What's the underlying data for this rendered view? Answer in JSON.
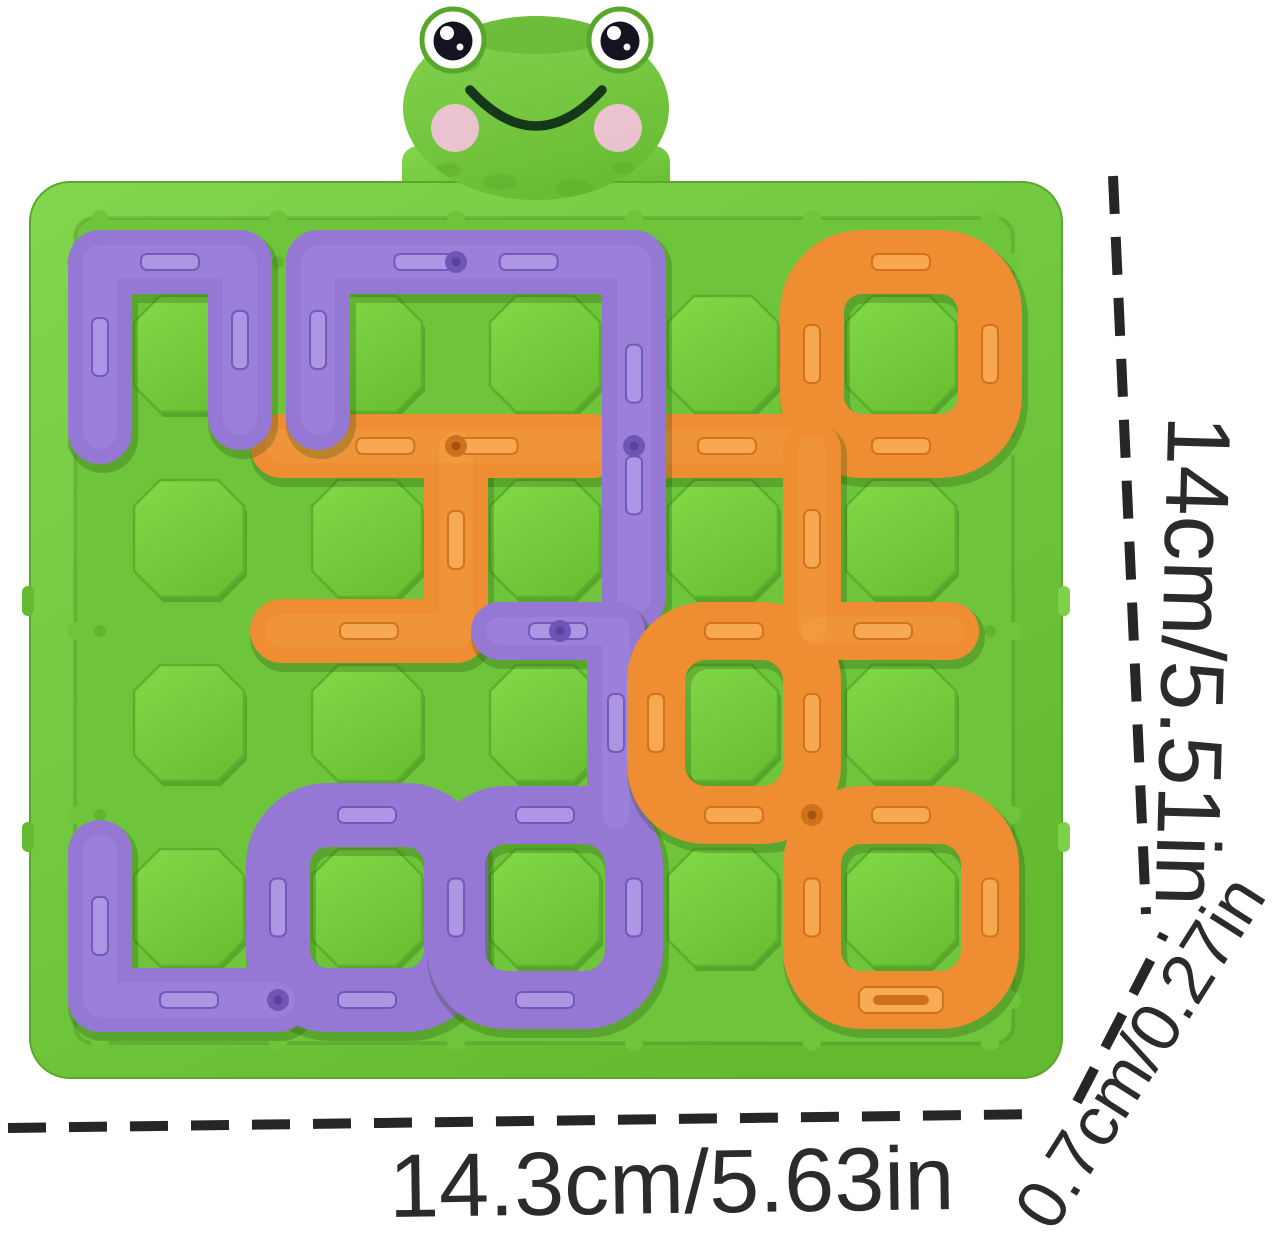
{
  "product": {
    "kind": "frog maze logic puzzle board",
    "annotations": {
      "height_label": "14cm/5.51in",
      "width_label": "14.3cm/5.63in",
      "thickness_label": "0.7cm/0.27in"
    },
    "annotation_style": {
      "color": "#262626",
      "dash": "38 23",
      "line_width": 10
    }
  },
  "board": {
    "colors": {
      "rim1": "#7ed24a",
      "rim2": "#64bb30",
      "field": "#6ec43a",
      "edge": "#5aa72b",
      "cell1": "#80d846",
      "cell2": "#69c133",
      "cellStroke": "#5bb02b",
      "peg": "#5dad2d",
      "shadow": "rgba(40,90,12,0.30)"
    },
    "grid": {
      "cols": 5,
      "rows": 4,
      "xs": [
        100,
        278,
        456,
        634,
        812,
        990
      ],
      "ys": [
        262,
        446,
        631,
        815,
        1000
      ],
      "track_width": 64
    },
    "piece_colors": {
      "purple": {
        "base": "#9577d4",
        "light": "#b09ae6",
        "dark": "#7154b8",
        "hole": "#5a4399"
      },
      "orange": {
        "base": "#ee8d31",
        "light": "#f8ab55",
        "dark": "#cf701a",
        "hole": "#a3540e"
      }
    },
    "pieces": [
      {
        "id": "orange-h-piece",
        "color": "orange",
        "paths": [
          [
            [
              282,
              446
            ],
            [
              592,
              446
            ]
          ],
          [
            [
              282,
              631
            ],
            [
              456,
              631
            ],
            [
              456,
              449
            ]
          ]
        ],
        "dots": [
          [
            456,
            446
          ]
        ]
      },
      {
        "id": "orange-top-right-loop",
        "color": "orange",
        "paths": [
          [
            [
              642,
              446
            ],
            [
              812,
              446
            ]
          ]
        ],
        "rings": [
          [
            812,
            262,
            990,
            446
          ]
        ],
        "dots": [
          [
            812,
            446
          ]
        ]
      },
      {
        "id": "purple-arch-left",
        "color": "purple",
        "paths": [
          [
            [
              100,
              432
            ],
            [
              100,
              262
            ],
            [
              240,
              262
            ],
            [
              240,
              418
            ]
          ]
        ]
      },
      {
        "id": "purple-arch-descender",
        "color": "purple",
        "paths": [
          [
            [
              318,
              418
            ],
            [
              318,
              262
            ],
            [
              634,
              262
            ],
            [
              634,
              597
            ]
          ]
        ],
        "dots": [
          [
            456,
            262
          ],
          [
            634,
            446
          ]
        ]
      },
      {
        "id": "purple-bottom-left-piece",
        "color": "purple",
        "paths": [
          [
            [
              100,
              852
            ],
            [
              100,
              1000
            ],
            [
              278,
              1000
            ]
          ]
        ],
        "rings": [
          [
            278,
            815,
            456,
            1000
          ]
        ],
        "dots": [
          [
            278,
            1000
          ]
        ]
      },
      {
        "id": "purple-s-piece",
        "color": "purple",
        "track_width": 58,
        "paths": [
          [
            [
              500,
              631
            ],
            [
              616,
              631
            ],
            [
              616,
              815
            ]
          ]
        ],
        "rings": [
          [
            456,
            815,
            634,
            1000
          ]
        ],
        "dots": [
          [
            560,
            631
          ]
        ]
      },
      {
        "id": "orange-right-loop",
        "color": "orange",
        "track_width": 58,
        "paths": [
          [
            [
              812,
              450
            ],
            [
              812,
              628
            ]
          ],
          [
            [
              816,
              631
            ],
            [
              950,
              631
            ]
          ]
        ],
        "rings": [
          [
            656,
            631,
            812,
            815
          ],
          [
            812,
            815,
            990,
            1000
          ]
        ],
        "dots": [
          [
            812,
            815
          ]
        ],
        "slots": [
          [
            901,
            1000
          ]
        ]
      }
    ]
  },
  "frog": {
    "colors": {
      "head1": "#84d14e",
      "head2": "#67bb33",
      "spot": "#5fae2e",
      "eyeRim": "#58a72c",
      "pupil": "#161321",
      "cheek": "#f5c2dc",
      "smile": "#15381a"
    }
  }
}
